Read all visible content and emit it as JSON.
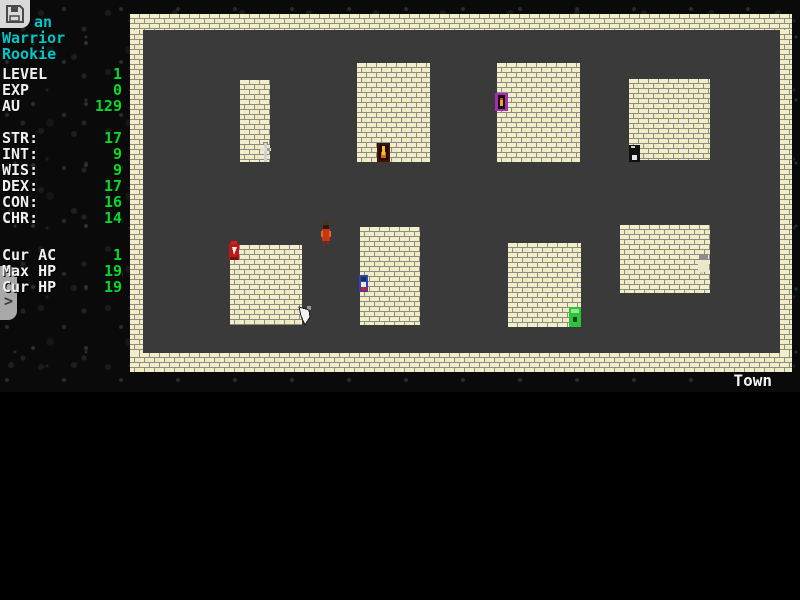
{
  "hud": {
    "name_visible": "an",
    "class_label": "Warrior",
    "rank_label": "Rookie",
    "progress_rows": [
      {
        "label": "LEVEL",
        "value": "1"
      },
      {
        "label": "EXP",
        "value": "0"
      },
      {
        "label": "AU",
        "value": "129"
      }
    ],
    "stat_rows": [
      {
        "label": "STR:",
        "value": "17"
      },
      {
        "label": "INT:",
        "value": "9"
      },
      {
        "label": "WIS:",
        "value": "9"
      },
      {
        "label": "DEX:",
        "value": "17"
      },
      {
        "label": "CON:",
        "value": "16"
      },
      {
        "label": "CHR:",
        "value": "14"
      }
    ],
    "derived_rows": [
      {
        "label": "Cur AC",
        "value": "1"
      },
      {
        "label": "Max HP",
        "value": "19"
      },
      {
        "label": "Cur HP",
        "value": "19"
      }
    ]
  },
  "toolbar": {
    "save_icon": "floppy-disk-icon",
    "drawer_chevron": ">"
  },
  "map": {
    "location_label": "Town",
    "entities": [
      "sword-sign",
      "torch-door",
      "purple-door",
      "dark-door",
      "red-knight",
      "white-dagger-sign",
      "blue-villager",
      "green-door",
      "white-creature",
      "red-wanderer"
    ]
  },
  "colors": {
    "text_cyan": "#00c8c8",
    "text_white": "#f0f0f0",
    "text_green": "#00dc28",
    "brick": "#f2eec9",
    "mortar": "#8d8d84",
    "floor": "#3a3a3a",
    "background": "#000000"
  }
}
